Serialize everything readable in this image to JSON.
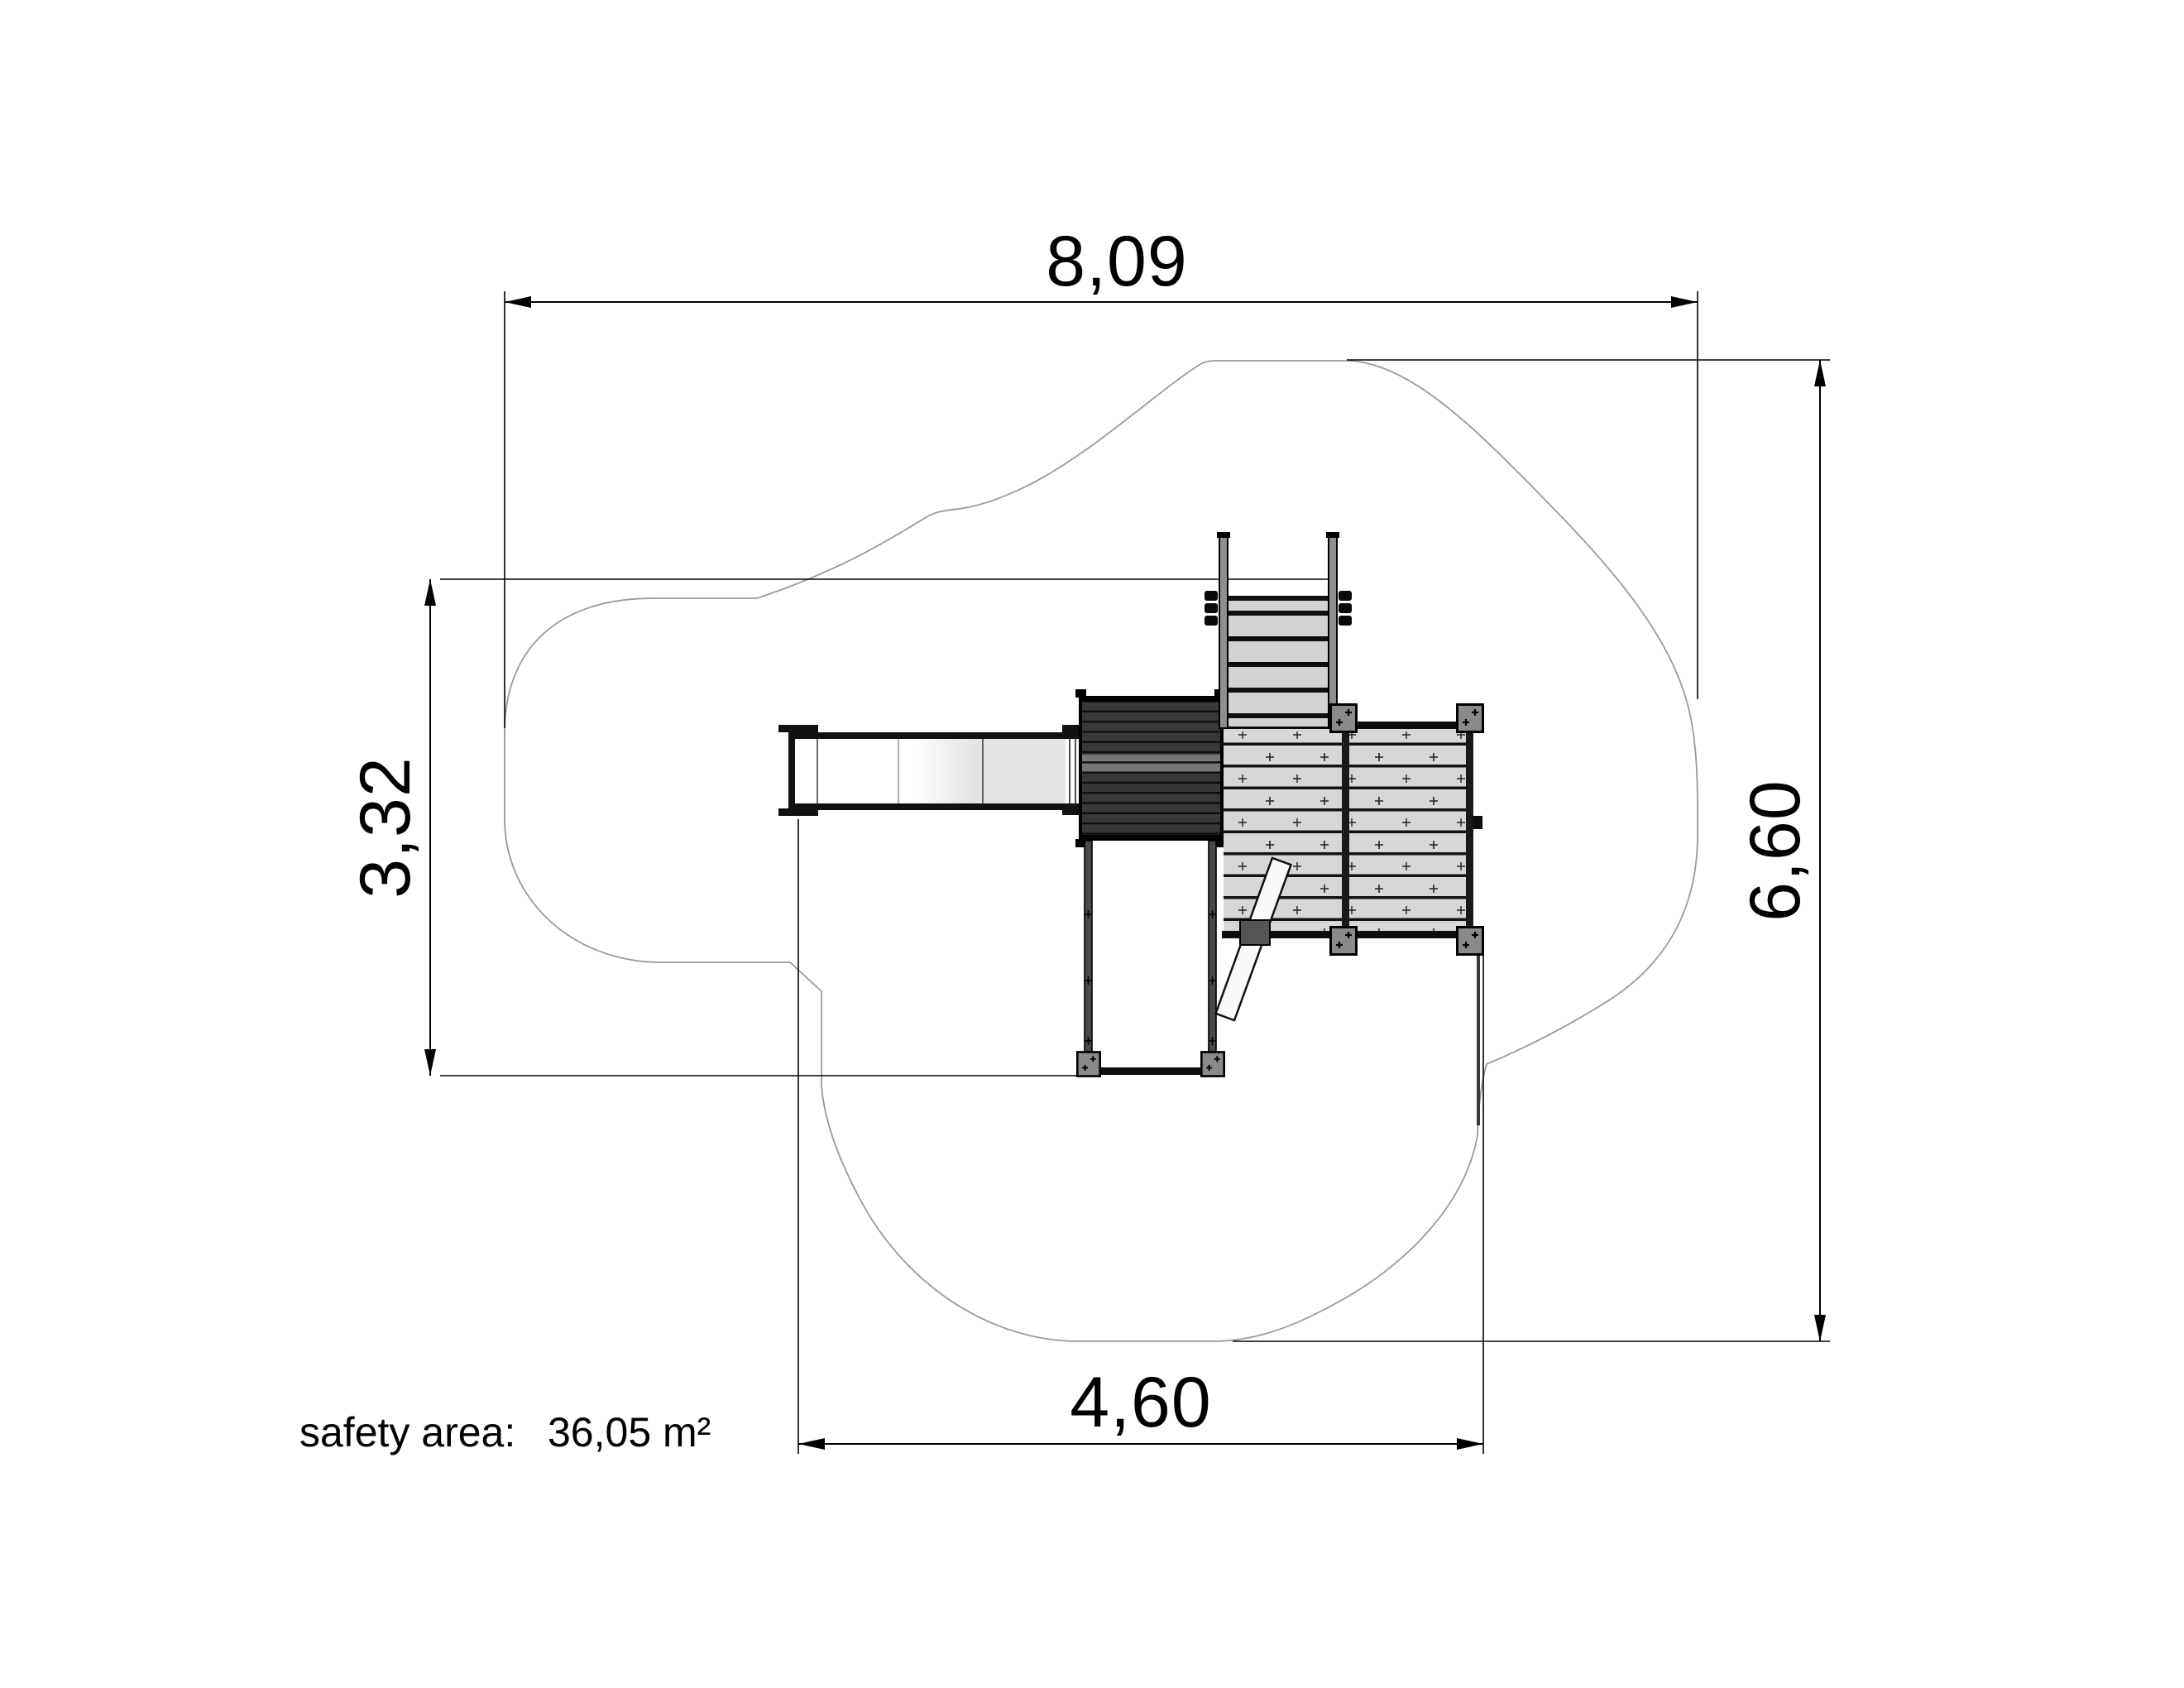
{
  "drawing": {
    "type": "playground-safety-area-plan",
    "dimensions": {
      "top_width": "8,09",
      "right_height": "6,60",
      "left_height": "3,32",
      "bottom_width": "4,60"
    },
    "safety_area": {
      "label": "safety area:",
      "value": "36,05 m²"
    },
    "colors": {
      "background": "#ffffff",
      "outline_gray": "#9a9a9a",
      "dimension_black": "#000000",
      "dark_platform": "#383838",
      "dark_platform_band": "#808080",
      "deck_slat": "#d7d7d7",
      "stair_step": "#d2d2d2",
      "post_gray": "#8a8a8a",
      "slide_bed_end": "#e3e3e3",
      "brace_white": "#fafafa",
      "clamp_gray": "#555555"
    }
  }
}
